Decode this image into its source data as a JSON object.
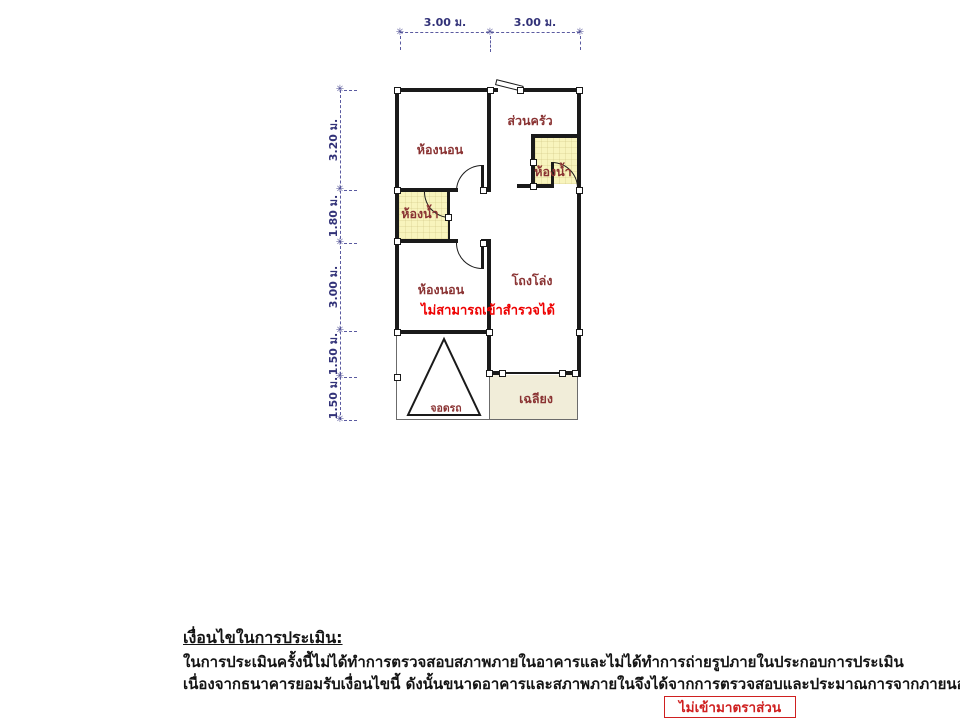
{
  "plan": {
    "dims_top": [
      "3.00 ม.",
      "3.00 ม."
    ],
    "dims_left": [
      "3.20 ม.",
      "1.80 ม.",
      "3.00 ม.",
      "1.50 ม.",
      "1.50 ม."
    ],
    "rooms": {
      "bedroom_top": "ห้องนอน",
      "kitchen": "ส่วนครัว",
      "bathroom_right": "ห้องน้ำ",
      "bathroom_left": "ห้องน้ำ",
      "bedroom_lower": "ห้องนอน",
      "hall": "โถงโล่ง",
      "carport": "จอดรถ",
      "porch": "เฉลียง"
    },
    "warning_note": "ไม่สามารถเข้าสำรวจได้",
    "tick_glyph": "✳"
  },
  "notes": {
    "heading": "เงื่อนไขในการประเมิน:",
    "line1": "ในการประเมินครั้งนี้ไม่ได้ทำการตรวจสอบสภาพภายในอาคารและไม่ได้ทำการถ่ายรูปภายในประกอบการประเมิน",
    "line2": "เนื่องจากธนาคารยอมรับเงื่อนไขนี้ ดังนั้นขนาดอาคารและสภาพภายในจึงได้จากการตรวจสอบและประมาณการจากภายนอกเท่านั้น"
  },
  "stamp": {
    "label": "ไม่เข้ามาตราส่วน"
  },
  "colors": {
    "wall": "#1a1a1a",
    "dimension": "#323278",
    "room_label": "#8a3333",
    "warning": "#ee0000",
    "stamp": "#cf2020",
    "bathroom_fill": "#f8f4bd",
    "porch_fill": "#f1edd9"
  }
}
